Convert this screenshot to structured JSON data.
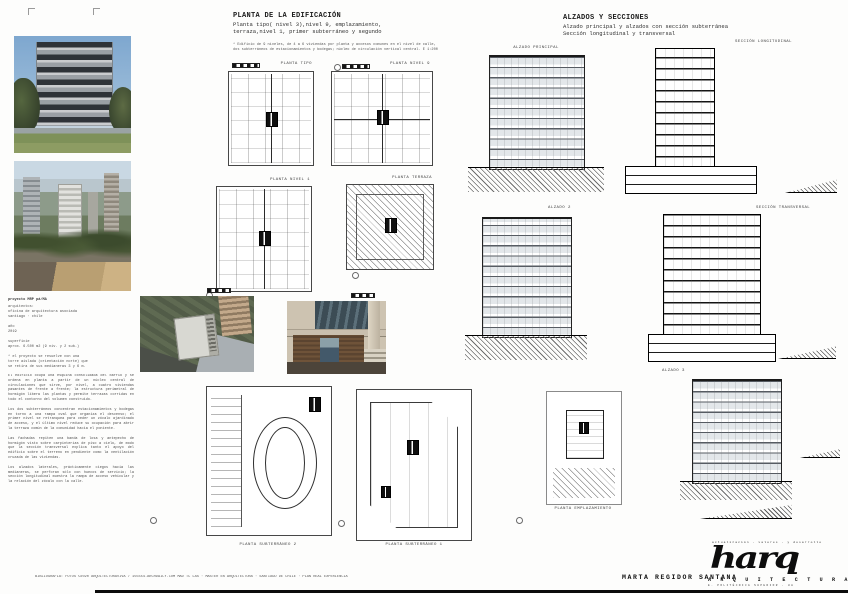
{
  "board": {
    "plans_header": {
      "title": "PLANTA DE LA EDIFICACIÓN",
      "subtitle1": "Planta tipo( nivel 3),nivel 9, emplazamiento,",
      "subtitle2": "terraza,nivel 1, primer subterráneo y segundo",
      "note": "* Edificio de 9 niveles, de 4 a 6 viviendas por planta y accesos comunes en el nivel de calle,\ndos subterráneos de estacionamientos y bodegas; núcleo de circulación vertical central. E 1:200"
    },
    "sections_header": {
      "title": "ALZADOS Y SECCIONES",
      "subtitle1": "Alzado principal y alzados con sección subterránea",
      "subtitle2": "Sección longitudinal y transversal"
    },
    "plans": [
      {
        "label": "PLANTA TIPO"
      },
      {
        "label": "PLANTA NIVEL 9"
      },
      {
        "label": "PLANTA NIVEL 1"
      },
      {
        "label": "PLANTA TERRAZA"
      },
      {
        "label": "PLANTA SUBTERRÁNEO 2"
      },
      {
        "label": "PLANTA SUBTERRÁNEO 1"
      },
      {
        "label": "PLANTA EMPLAZAMIENTO"
      }
    ],
    "elevations": [
      {
        "label": "ALZADO PRINCIPAL"
      },
      {
        "label": "SECCIÓN LONGITUDINAL"
      },
      {
        "label": "ALZADO 2"
      },
      {
        "label": "SECCIÓN TRANSVERSAL"
      },
      {
        "label": "ALZADO 3"
      }
    ],
    "info": {
      "title": "proyecto MRP pá/MA",
      "body": "arquitectos:\n oficina de arquitectura asociada\n santiago · chile\n\naño\n 2019\n\nsuperficie\n aprox. 6.500 m2 (9 niv. y 2 sub.)\n\n* el proyecto se resuelve con una\ntorre aislada (orientación norte) que\nse retira de sus medianeras 3 y 6 m."
    },
    "description": "El edificio ocupa una esquina consolidada del barrio y se ordena en planta a partir de un núcleo central de circulaciones que sirve, por nivel, a cuatro viviendas pasantes de frente a frente; la estructura perimetral de hormigón libera las plantas y permite terrazas corridas en todo el contorno del volumen construido.\n\nLos dos subterráneos concentran estacionamientos y bodegas en torno a una rampa oval que organiza el descenso; el primer nivel se retranquea para ceder un zócalo ajardinado de acceso, y el último nivel reduce su ocupación para abrir la terraza común de la comunidad hacia el poniente.\n\nLas fachadas repiten una banda de losa y antepecho de hormigón visto sobre carpinterías de piso a cielo, de modo que la sección transversal explica tanto el apoyo del edificio sobre el terreno en pendiente como la ventilación cruzada de las viviendas.\n\nLos alzados laterales, prácticamente ciegos hacia las medianeras, se perforan sólo con huecos de servicio; la sección longitudinal muestra la rampa de acceso vehicular y la relación del zócalo con la calle.",
    "footer": {
      "bibliography": "BIBLIOGRAFÍA: FOTOS ©2020 ARQUITECTURAVIVA / 155554.ARCHDAILY.COM MAD TC LAS · MÁSTER EN ARQUITECTURA · SANTIAGO DE CHILE · PLAN REAL EXPERIENCIA",
      "author": "MARTA REGIDOR SANTANA",
      "logo_tagline": "actualización · valores · y desarrollo",
      "logo_script": "harq",
      "logo_word": "A R Q U I T E C T U R A",
      "logo_subline": "E. POLITÉCNICA SUPERIOR · UA"
    }
  }
}
